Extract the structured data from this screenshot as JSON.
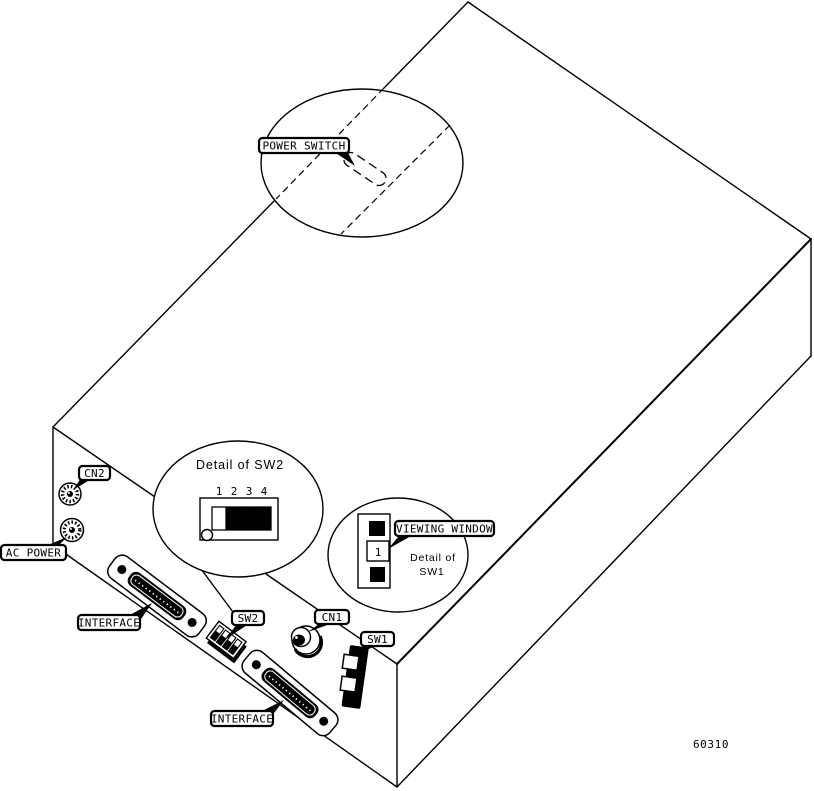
{
  "figure": {
    "number": "60310",
    "background": "#ffffff",
    "ink": "#000000"
  },
  "callouts": {
    "power_switch": "POWER SWITCH",
    "cn2": "CN2",
    "ac_power": "AC POWER",
    "interface_upper": "INTERFACE",
    "sw2": "SW2",
    "cn1": "CN1",
    "sw1": "SW1",
    "interface_lower": "INTERFACE",
    "viewing_window": "VIEWING WINDOW"
  },
  "details": {
    "sw2": {
      "title": "Detail of SW2",
      "positions": [
        "1",
        "2",
        "3",
        "4"
      ],
      "switch_states": [
        "off",
        "on",
        "on",
        "on"
      ]
    },
    "sw1": {
      "title_line1": "Detail of",
      "title_line2": "SW1",
      "window_value": "1"
    }
  }
}
